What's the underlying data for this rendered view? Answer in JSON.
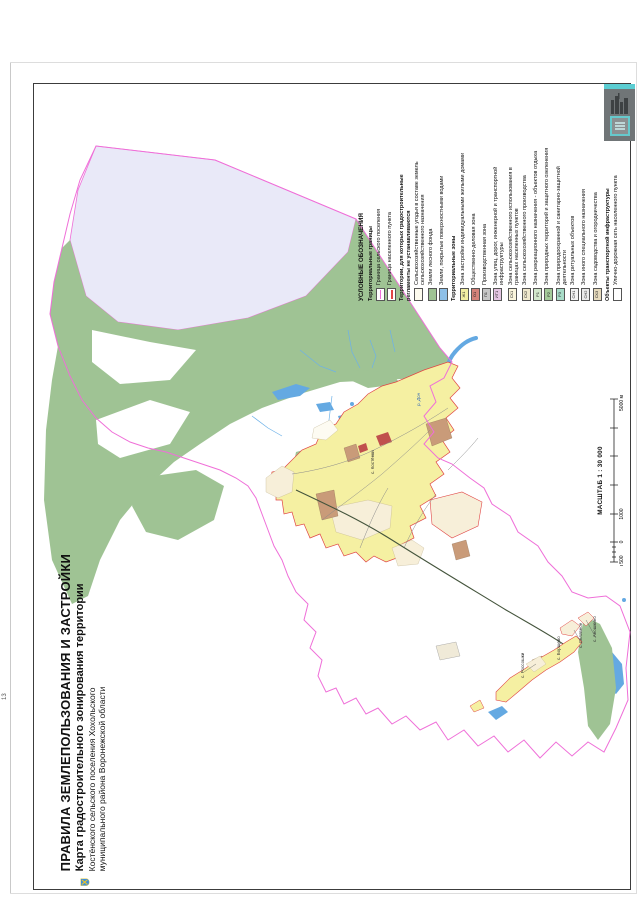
{
  "page_number": "13",
  "title_block": {
    "line1": "ПРАВИЛА ЗЕМЛЕПОЛЬЗОВАНИЯ И ЗАСТРОЙКИ",
    "line2": "Карта градостроительного зонирования территории",
    "line3": "Костёнского сельского поселения Хохольского",
    "line4": "муниципального района Воронежской области"
  },
  "legend": {
    "title": "УСЛОВНЫЕ ОБОЗНАЧЕНИЯ",
    "sections": [
      {
        "header": "Территориальные границы",
        "items": [
          {
            "swatch": "line",
            "color": "#ef6fd8",
            "code": "",
            "label": "Граница сельского поселения"
          },
          {
            "swatch": "line",
            "color": "#e04545",
            "code": "",
            "label": "Граница населенного пункта"
          }
        ]
      },
      {
        "header": "Территории, для которых градостроительные регламенты не устанавливаются",
        "items": [
          {
            "swatch": "box",
            "color": "#fdfbee",
            "code": "",
            "label": "Сельскохозяйственные угодья в составе земель сельскохозяйственного назначения"
          },
          {
            "swatch": "box",
            "color": "#9fc394",
            "code": "",
            "label": "Земли лесного фонда"
          },
          {
            "swatch": "box",
            "color": "#8ec0e8",
            "code": "",
            "label": "Земли, покрытые поверхностными водами"
          }
        ]
      },
      {
        "header": "Территориальные зоны",
        "items": [
          {
            "swatch": "box",
            "color": "#f2eea2",
            "code": "Ж1",
            "label": "Зона застройки индивидуальными жилыми домами"
          },
          {
            "swatch": "box",
            "color": "#d4827a",
            "code": "О1",
            "label": "Общественно-деловая зона"
          },
          {
            "swatch": "box",
            "color": "#c6c6c6",
            "code": "П1",
            "label": "Производственная зона"
          },
          {
            "swatch": "box",
            "color": "#e5c6e3",
            "code": "ИТ1",
            "label": "Зона улиц, дорог, инженерной и транспортной инфраструктуры"
          },
          {
            "swatch": "box",
            "color": "#faf5dc",
            "code": "СХ1",
            "label": "Зона сельскохозяйственного использования в границах населенных пунктов"
          },
          {
            "swatch": "box",
            "color": "#efe8cd",
            "code": "СХ2",
            "label": "Зона сельскохозяйственного производства"
          },
          {
            "swatch": "box",
            "color": "#d2e8cc",
            "code": "Р1",
            "label": "Зона рекреационного назначения - объектов отдыха"
          },
          {
            "swatch": "box",
            "color": "#a4cb9a",
            "code": "Р2",
            "label": "Зона природных территорий и защитного озеленения"
          },
          {
            "swatch": "box",
            "color": "#a8dcc8",
            "code": "Р3",
            "label": "Зона природоохранной и санитарно-защитной деятельности"
          },
          {
            "swatch": "box",
            "color": "#f4f4f4",
            "code": "СН1",
            "label": "Зона ритуальных объектов"
          },
          {
            "swatch": "box",
            "color": "#ebebeb",
            "code": "СН2",
            "label": "Зона иного специального назначения"
          },
          {
            "swatch": "box",
            "color": "#e7dbbd",
            "code": "СХ3",
            "label": "Зона садоводства и огородничества"
          }
        ]
      },
      {
        "header": "Объекты транспортной инфраструктуры",
        "items": [
          {
            "swatch": "box",
            "color": "#ffffff",
            "code": "",
            "label": "Улично-дорожная сеть населенного пункта"
          }
        ]
      }
    ]
  },
  "scale": {
    "title": "МАСШТАБ 1 : 30 000",
    "labels": {
      "start": "м 500",
      "zero": "0",
      "k1": "1000",
      "k5": "5000 м"
    }
  },
  "map_labels": [
    {
      "text": "р. Дон",
      "x": 420,
      "y": 406,
      "color": "#3b6fb5",
      "italic": true
    },
    {
      "text": "с. Костёнки",
      "x": 374,
      "y": 474,
      "color": "#333333",
      "italic": false
    },
    {
      "text": "с. Россошки",
      "x": 524,
      "y": 678,
      "color": "#333333",
      "italic": false
    },
    {
      "text": "с. Борщево",
      "x": 560,
      "y": 660,
      "color": "#333333",
      "italic": false
    },
    {
      "text": "с. Селявное",
      "x": 582,
      "y": 648,
      "color": "#333333",
      "italic": false
    },
    {
      "text": "с. Аношкино",
      "x": 596,
      "y": 642,
      "color": "#333333",
      "italic": false
    }
  ],
  "colors": {
    "settlement_boundary": "#ef6fd8",
    "locality_boundary": "#e04545",
    "water": "#64a9e2",
    "forest": "#9fc394",
    "farmland": "#fdfbee",
    "agr_lands_outside": "#e9e9f8",
    "residential": "#f5f0a2",
    "public_business": "#c0504d",
    "production_tan": "#c99b79",
    "road_dark": "#44543c"
  }
}
